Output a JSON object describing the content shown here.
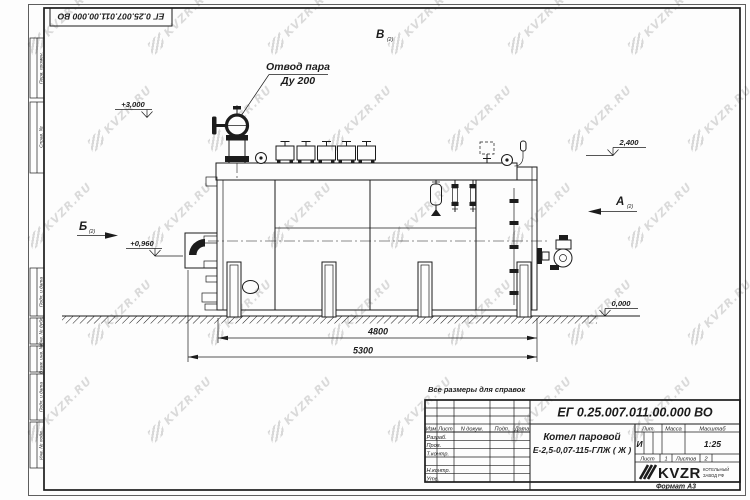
{
  "watermark": {
    "text": "KVZR.RU"
  },
  "corner_stamp": {
    "designation": "ЕГ 0.25.007.011.00.000  ВО"
  },
  "margin": {
    "labels": [
      "Перв. примен.",
      "Справ. №",
      "Подп. и дата",
      "Инв. № дубл.",
      "Взам. инв. №",
      "Подп. и дата",
      "Инв. № подл."
    ]
  },
  "drawing": {
    "note": "Все размеры для справок",
    "callout_line1": "Отвод пара",
    "callout_line2": "Ду 200",
    "view_v": "В",
    "view_a": "А",
    "view_b": "Б",
    "view_ref": "(2)",
    "elev_3000": "+3,000",
    "elev_2400": "2,400",
    "elev_0960": "+0,960",
    "elev_0000": "0,000",
    "dim_4800": "4800",
    "dim_5300": "5300"
  },
  "title_block": {
    "designation": "ЕГ 0.25.007.011.00.000  ВО",
    "product_name": "Котел паровой",
    "product_model": "Е-2,5-0,07-115-ГЛЖ ( Ж )",
    "col_izm": "Изм",
    "col_list": "Лист",
    "col_doc": "N докум.",
    "col_sign": "Подп.",
    "col_date": "Дата",
    "row_razrab": "Разраб.",
    "row_prov": "Пров.",
    "row_tkontr": "Т.контр.",
    "row_nkontr": "Н.контр.",
    "row_utv": "Утв.",
    "lit_label": "Лит.",
    "mass_label": "Масса",
    "scale_label": "Масштаб",
    "lit_value": "И",
    "scale_value": "1:25",
    "sheet_label": "Лист",
    "sheet_value": "1",
    "sheets_label": "Листов",
    "sheets_value": "2",
    "company_name": "KVZR",
    "company_sub1": "КОТЕЛЬНЫЙ",
    "company_sub2": "ЗАВОД РФ",
    "format_label": "Формат А3"
  }
}
